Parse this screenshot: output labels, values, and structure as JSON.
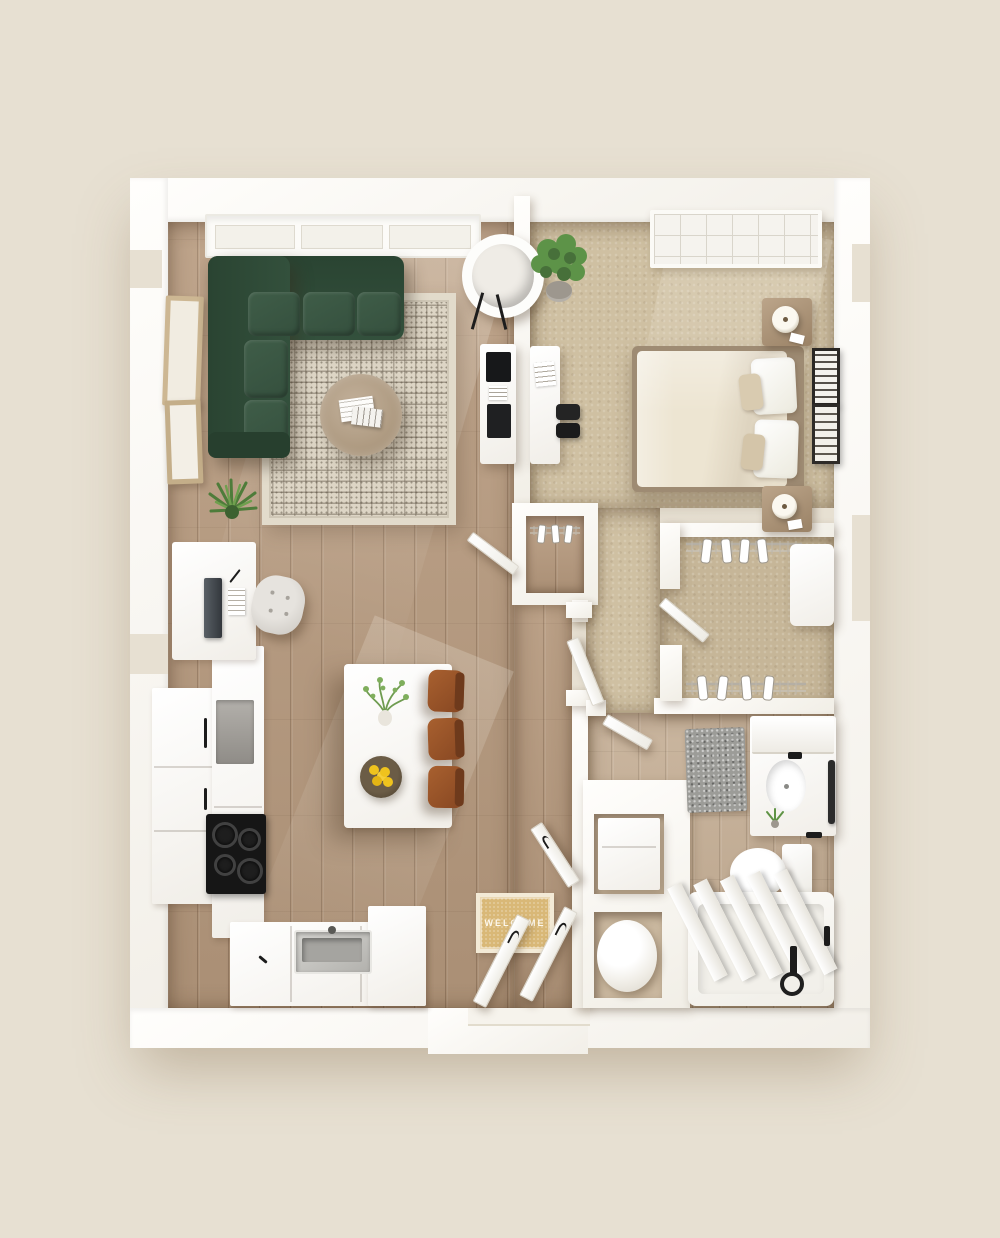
{
  "scene": {
    "type": "floor-plan-3d-top-view",
    "description": "3D rendered top-down floor plan of a one-bedroom apartment on a beige background",
    "welcome_mat": {
      "text": "WELCOME"
    },
    "rooms": [
      "living-room",
      "kitchen-dining",
      "bedroom",
      "bedroom-nook",
      "walk-in-closet",
      "bathroom",
      "laundry-closet",
      "coat-closet",
      "entry-hall"
    ],
    "furniture": {
      "living-room": [
        "green-sectional-sofa",
        "geometric-area-rug",
        "round-coffee-table",
        "magazines",
        "papasan-chair",
        "media-console",
        "tv",
        "potted-plant",
        "wall-art-frames",
        "windows"
      ],
      "kitchen-dining": [
        "refrigerator-tall-cabinets",
        "wall-oven",
        "cooktop",
        "sink",
        "l-shaped-counter",
        "kitchen-island",
        "vase-with-greenery",
        "bowl-of-lemons",
        "three-wood-stools",
        "desk",
        "laptop",
        "tufted-pouf"
      ],
      "bedroom": [
        "queen-bed",
        "cream-duvet",
        "white-pillows",
        "tan-accent-pillows",
        "wood-headboard",
        "nightstand-north",
        "nightstand-south",
        "table-lamps",
        "desk-with-chair",
        "potted-plant",
        "gallery-frames",
        "gridded-window"
      ],
      "walk-in-closet": [
        "wire-shelving-north",
        "wire-shelving-south",
        "hanging-clothes",
        "dresser-unit",
        "closet-door"
      ],
      "bathroom": [
        "vanity-with-sink",
        "mirror-ledge",
        "black-faucet",
        "toilet",
        "bathtub-with-curtain",
        "black-tub-filler",
        "speckled-bath-mat",
        "towel-bar",
        "small-plant"
      ],
      "laundry-closet": [
        "washer-cube",
        "water-heater-cylinder"
      ],
      "coat-closet": [
        "wire-shelf-with-hangers",
        "closet-door"
      ],
      "entry-hall": [
        "welcome-mat",
        "entry-door-leaves",
        "corridor-door"
      ]
    }
  },
  "palette": {
    "bg": "#e7e0d2",
    "wall": "#fbfaf7",
    "wood": "#b79a7e",
    "tile": "#c3ac92",
    "carpet": "#cfc0a2",
    "carpet_closet": "#c6b698",
    "sofa": "#2f4c38",
    "sofa_cushion": "#3f5d48",
    "rug_base": "#ddd5c5",
    "table_wood": "#b4a28c",
    "chair_wood": "#a0572d",
    "lemon": "#efc31e",
    "mat": "#d9b877",
    "mat_border": "#f3ead6",
    "mat_text": "#fdf8ec",
    "black": "#222222",
    "pouf": "#dbd8d2",
    "headboard": "#b49878",
    "duvet": "#ede5d2",
    "gray_rug": "#9c9c98"
  }
}
